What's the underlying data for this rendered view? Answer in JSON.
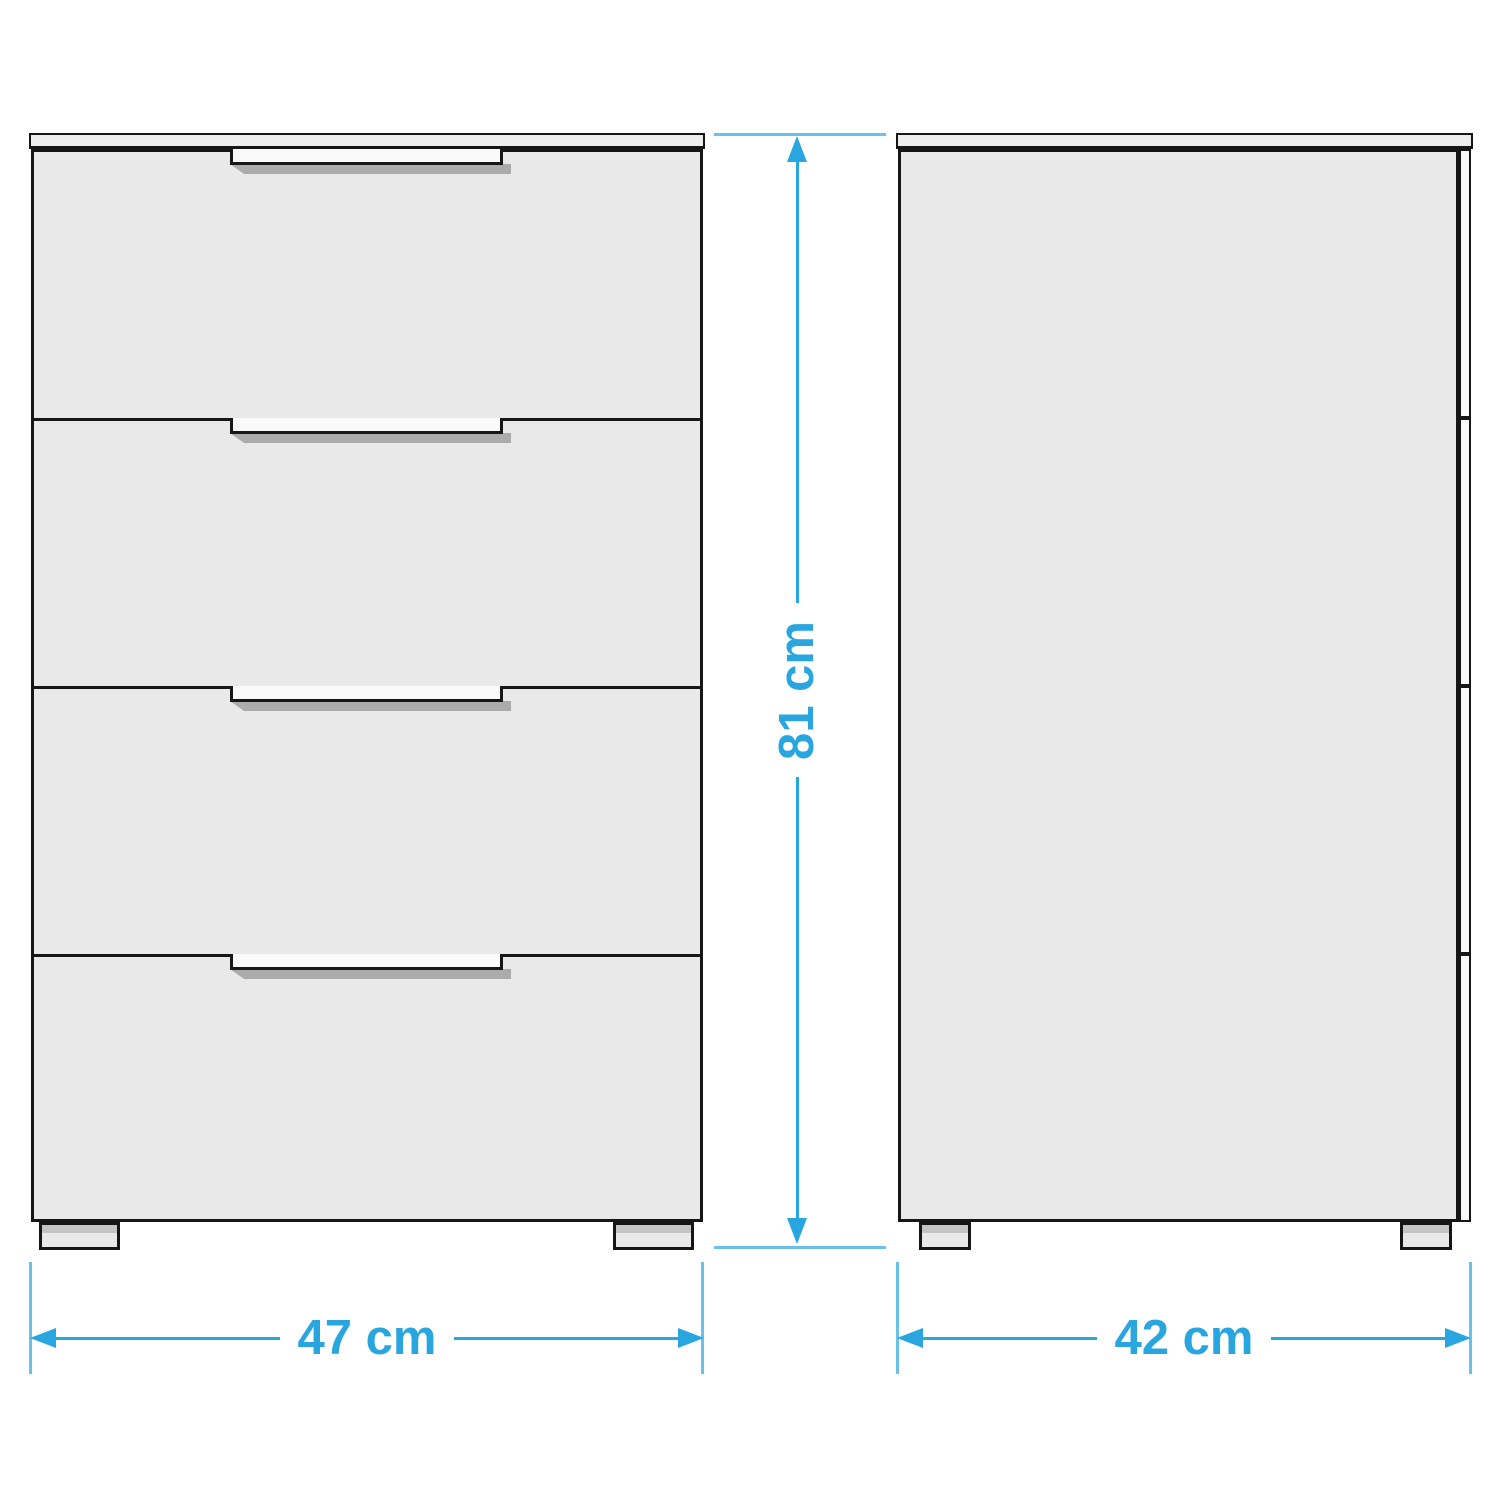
{
  "diagram": {
    "kind": "furniture-dimension-diagram",
    "subject": "chest of drawers",
    "drawer_count": 4,
    "views": [
      "front",
      "side"
    ]
  },
  "dimensions": {
    "width": {
      "value": 47,
      "unit": "cm",
      "label": "47 cm"
    },
    "height": {
      "value": 81,
      "unit": "cm",
      "label": "81 cm"
    },
    "depth": {
      "value": 42,
      "unit": "cm",
      "label": "42 cm"
    }
  },
  "colors": {
    "accent": "#29A5DF",
    "outline": "#161616",
    "panel_fill": "#E9E9E9",
    "top_fill": "#EEEEEE",
    "handle_fill": "#FAFAFA",
    "shadow": "#ABABAB",
    "foot_top": "#C4C4C4",
    "background": "#FFFFFF"
  }
}
